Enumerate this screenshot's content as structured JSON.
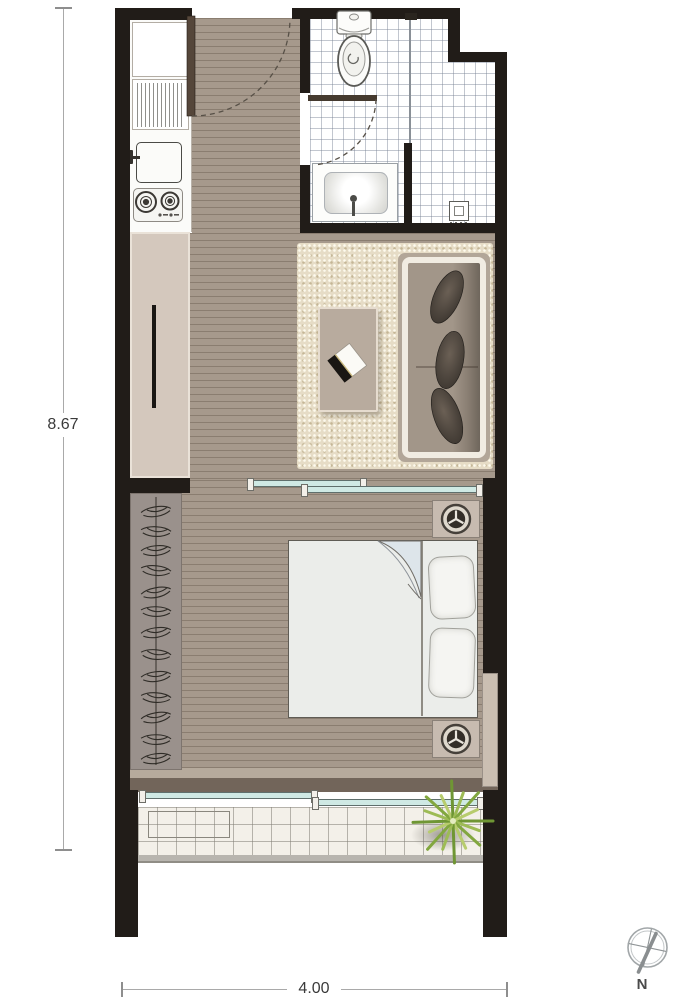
{
  "plan": {
    "dimensions": {
      "height_label": "8.67",
      "width_label": "4.00"
    },
    "compass": {
      "north_label": "N"
    }
  },
  "colors": {
    "wall": "#211c18",
    "wood": "#a6998c",
    "kitchen": "#fbfbf9",
    "cabinet": "#d4c8bd",
    "wardrobe": "#9a918c",
    "rug": "#e6dcc6",
    "bed": "#ebedea",
    "glass": "#cfe9e4",
    "balcony": "#f3f0e9",
    "railing": "#b8b5af",
    "door_leaf": "#55463a",
    "cushion": "#4e463e",
    "plant": "#82a73f"
  },
  "icons": {
    "compass": "circle-with-needle-and-cross",
    "table-lamp": "three-spoke-circle",
    "hangers": "squiggle-rail",
    "stove": "two-burner-circles",
    "book": "rotated-open-book",
    "plant": "radial-spiky-leaves"
  }
}
